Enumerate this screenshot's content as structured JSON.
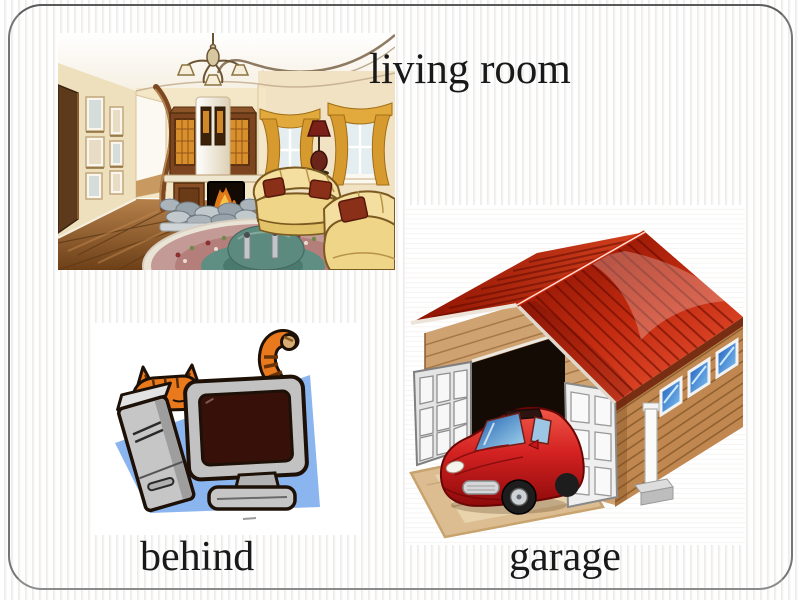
{
  "labels": {
    "living_room": "living room",
    "behind": "behind",
    "garage": "garage"
  },
  "pictures": {
    "living_room": "living room interior illustration",
    "behind": "orange cat hiding behind a desktop computer",
    "garage": "garage with open doors and a red car inside"
  },
  "colors": {
    "frame_border": "#757575",
    "background_stripe": "#e9e8e6",
    "label_text": "#191919",
    "roof_red": "#c22b10",
    "car_red": "#d42222",
    "cat_orange": "#e8791c",
    "backdrop_blue": "#8ab5ef",
    "wood_tan": "#c08850",
    "sofa_yellow": "#f2dc96",
    "curtain_gold": "#d79a2e"
  }
}
